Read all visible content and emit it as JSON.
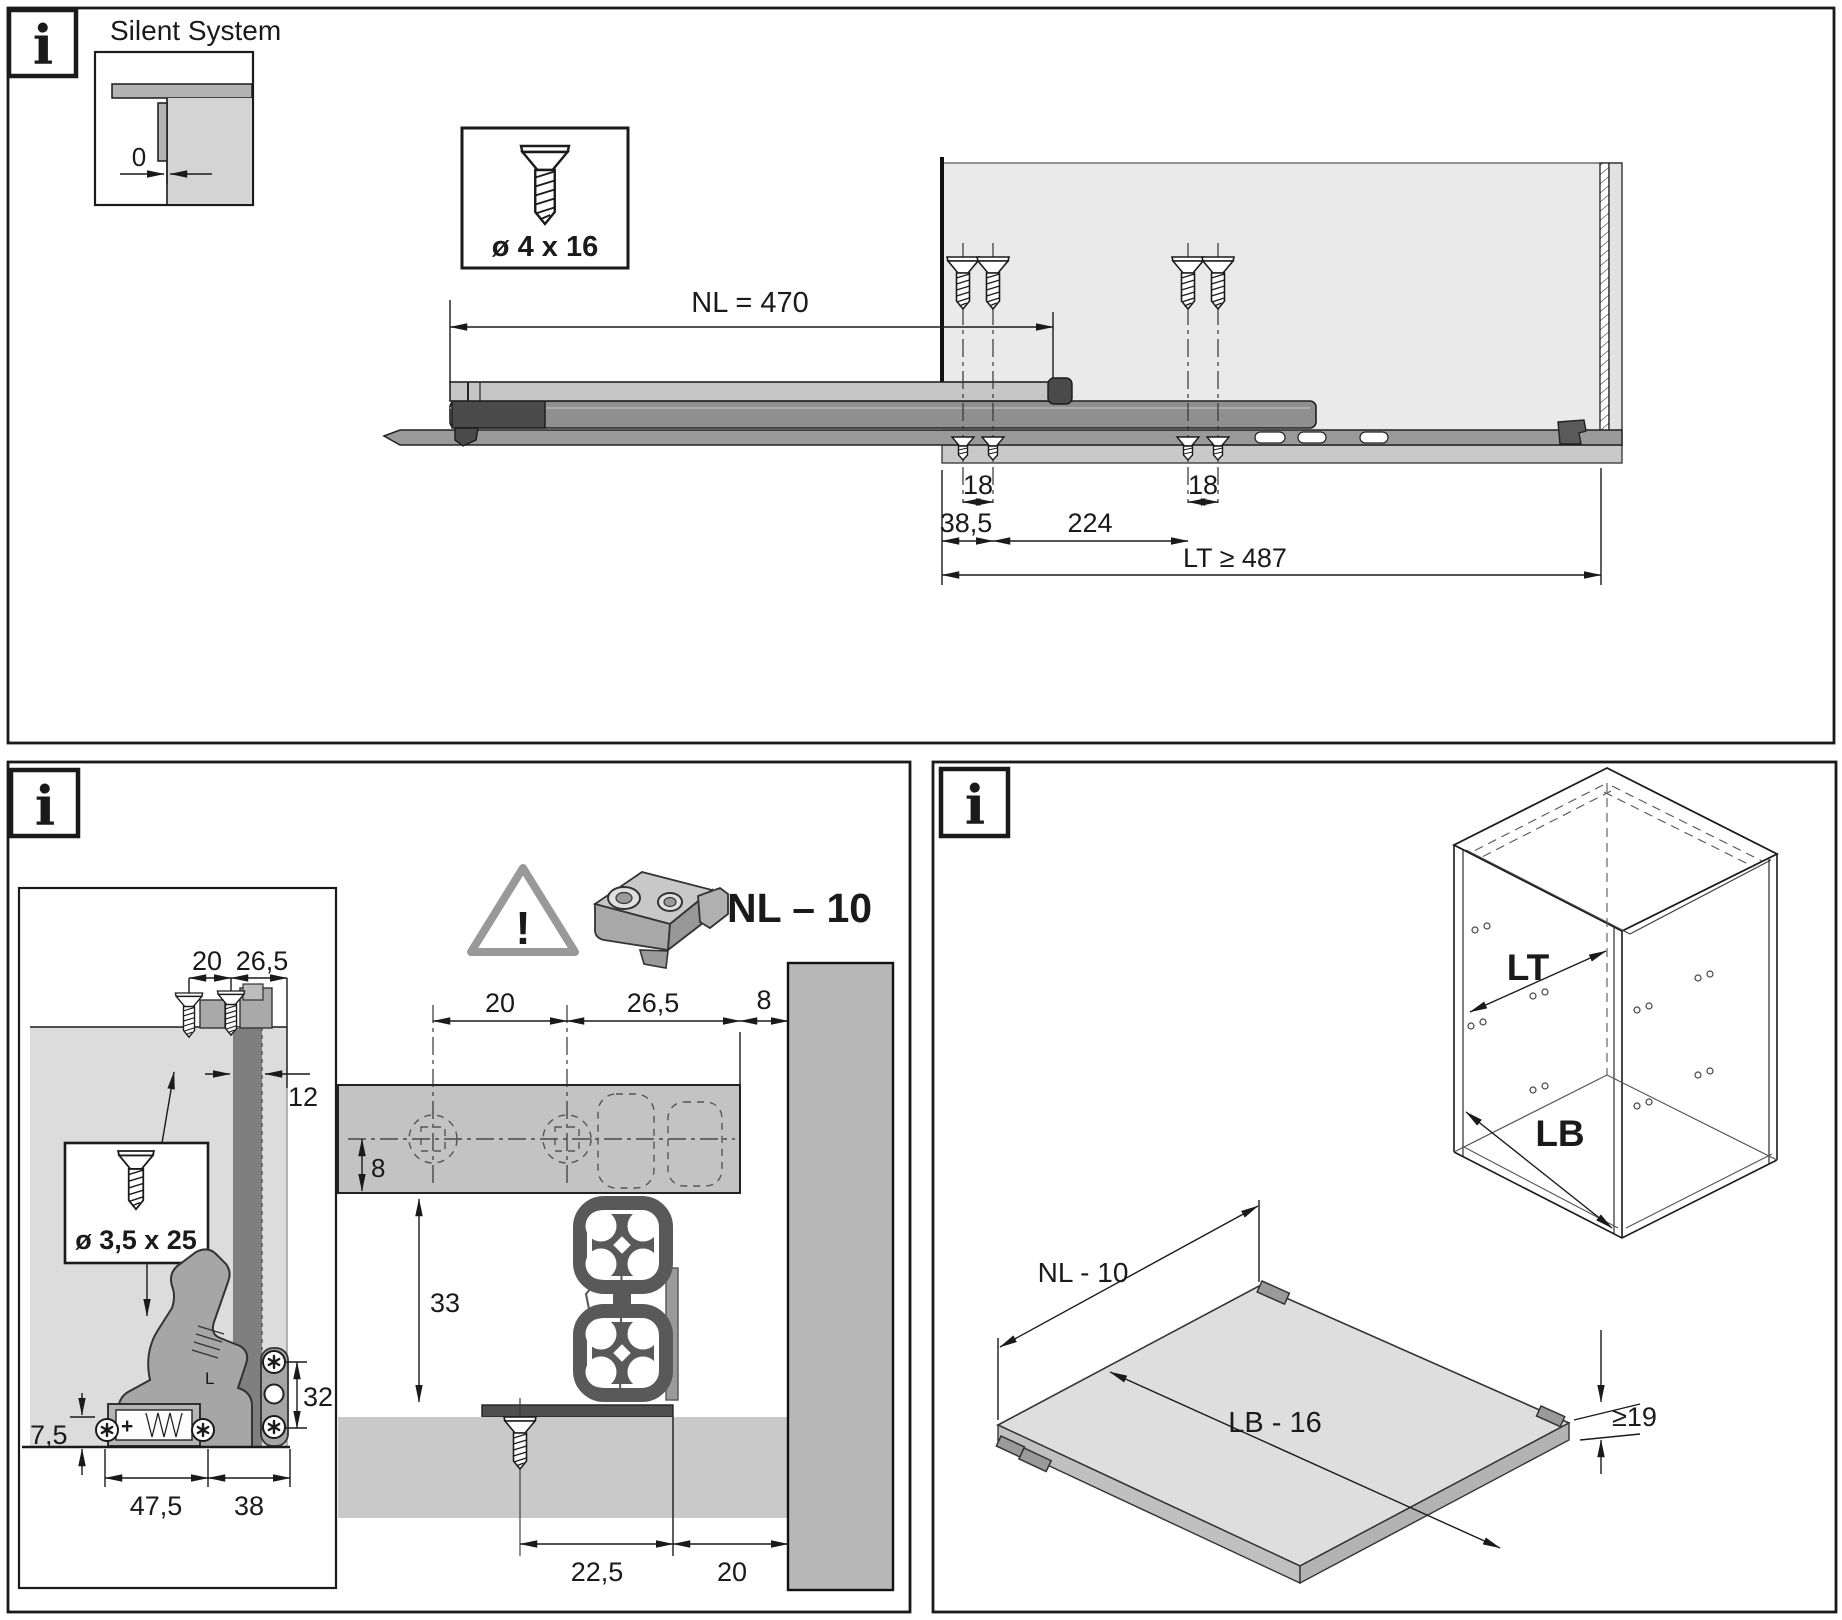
{
  "icons": {
    "info": "i",
    "warning": "!"
  },
  "top_panel": {
    "title": "Silent System",
    "zero_gap": "0",
    "screw_spec": "ø 4 x 16",
    "dims": {
      "nominal_length": "NL = 470",
      "screw_pitch_front": "18",
      "screw_pitch_rear": "18",
      "front_offset": "38,5",
      "between_screws": "224",
      "cabinet_depth": "LT ≥ 487"
    }
  },
  "bottom_left_panel": {
    "back_panel_view": {
      "top_a": "20",
      "top_b": "26,5",
      "panel_thickness": "12",
      "screw_spec": "ø 3,5 x 25",
      "bottom_edge": "7,5",
      "bottom_a": "47,5",
      "bottom_b": "38",
      "side_pitch": "32",
      "part_marking": "L",
      "adjuster_marking": "+"
    },
    "coupling_view": {
      "length_note": "NL – 10",
      "top_a": "20",
      "top_b": "26,5",
      "top_c": "8",
      "inset": "8",
      "height": "33",
      "bottom_a": "22,5",
      "bottom_b": "20"
    }
  },
  "bottom_right_panel": {
    "cabinet": {
      "depth": "LT",
      "width": "LB"
    },
    "shelf": {
      "length": "NL - 10",
      "width": "LB - 16",
      "thickness": "≥19"
    }
  }
}
